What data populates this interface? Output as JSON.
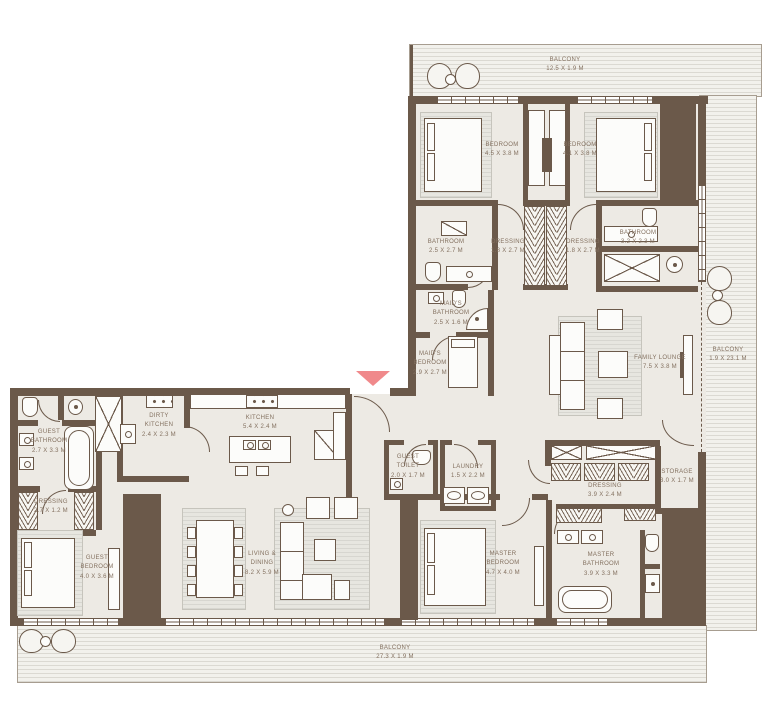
{
  "plan": {
    "colors": {
      "wall": "#6b594a",
      "floor": "#edeae4",
      "balcony_base": "#f2f1ec",
      "balcony_stripe": "#dbd9d2",
      "entrance_accent": "#f0898b",
      "label_text": "#83705f"
    },
    "rooms": {
      "balcony_top": {
        "name": "BALCONY",
        "dims": "12.5 x 1.9 M"
      },
      "balcony_right": {
        "name": "BALCONY",
        "dims": "1.9 x 23.1 M"
      },
      "balcony_bottom": {
        "name": "BALCONY",
        "dims": "27.3 x 1.9 M"
      },
      "bedroom_1": {
        "name": "BEDROOM",
        "dims": "4.5 x 3.8 M"
      },
      "bedroom_2": {
        "name": "BEDROOM",
        "dims": "4.1 x 3.8 M"
      },
      "bathroom_1": {
        "name": "BATHROOM",
        "dims": "2.5 x 2.7 M"
      },
      "dressing_1": {
        "name": "DRESSING",
        "dims": "1.8 x 2.7 M"
      },
      "dressing_2": {
        "name": "DRESSING",
        "dims": "1.8 x 2.7 M"
      },
      "bathroom_2": {
        "name": "BATHROOM",
        "dims": "3.2 x 2.3 M"
      },
      "maids_bathroom": {
        "name": "MAID'S BATHROOM",
        "dims": "2.5 x 1.6 M"
      },
      "maids_bedroom": {
        "name": "MAID'S BEDROOM",
        "dims": "2.9 x 2.7 M"
      },
      "family_lounge": {
        "name": "FAMILY LOUNGE",
        "dims": "7.5 x 3.8 M"
      },
      "guest_bathroom": {
        "name": "GUEST BATHROOM",
        "dims": "2.7 x 3.3 M"
      },
      "dressing_guest": {
        "name": "DRESSING",
        "dims": "2.7 x 1.2 M"
      },
      "guest_bedroom": {
        "name": "GUEST BEDROOM",
        "dims": "4.0 x 3.6 M"
      },
      "dirty_kitchen": {
        "name": "DIRTY KITCHEN",
        "dims": "2.4 x 2.3 M"
      },
      "kitchen": {
        "name": "KITCHEN",
        "dims": "5.4 x 2.4 M"
      },
      "living_dining": {
        "name": "LIVING & DINING",
        "dims": "8.2 x 5.9 M"
      },
      "guest_toilet": {
        "name": "GUEST TOILET",
        "dims": "2.0 x 1.7 M"
      },
      "laundry": {
        "name": "LAUNDRY",
        "dims": "1.5 x 2.2 M"
      },
      "dressing_master": {
        "name": "DRESSING",
        "dims": "3.9 x 2.4 M"
      },
      "storage": {
        "name": "STORAGE",
        "dims": "3.0 x 1.7 M"
      },
      "master_bedroom": {
        "name": "MASTER BEDROOM",
        "dims": "4.7 x 4.0 M"
      },
      "master_bathroom": {
        "name": "MASTER BATHROOM",
        "dims": "3.9 x 3.3 M"
      }
    }
  }
}
